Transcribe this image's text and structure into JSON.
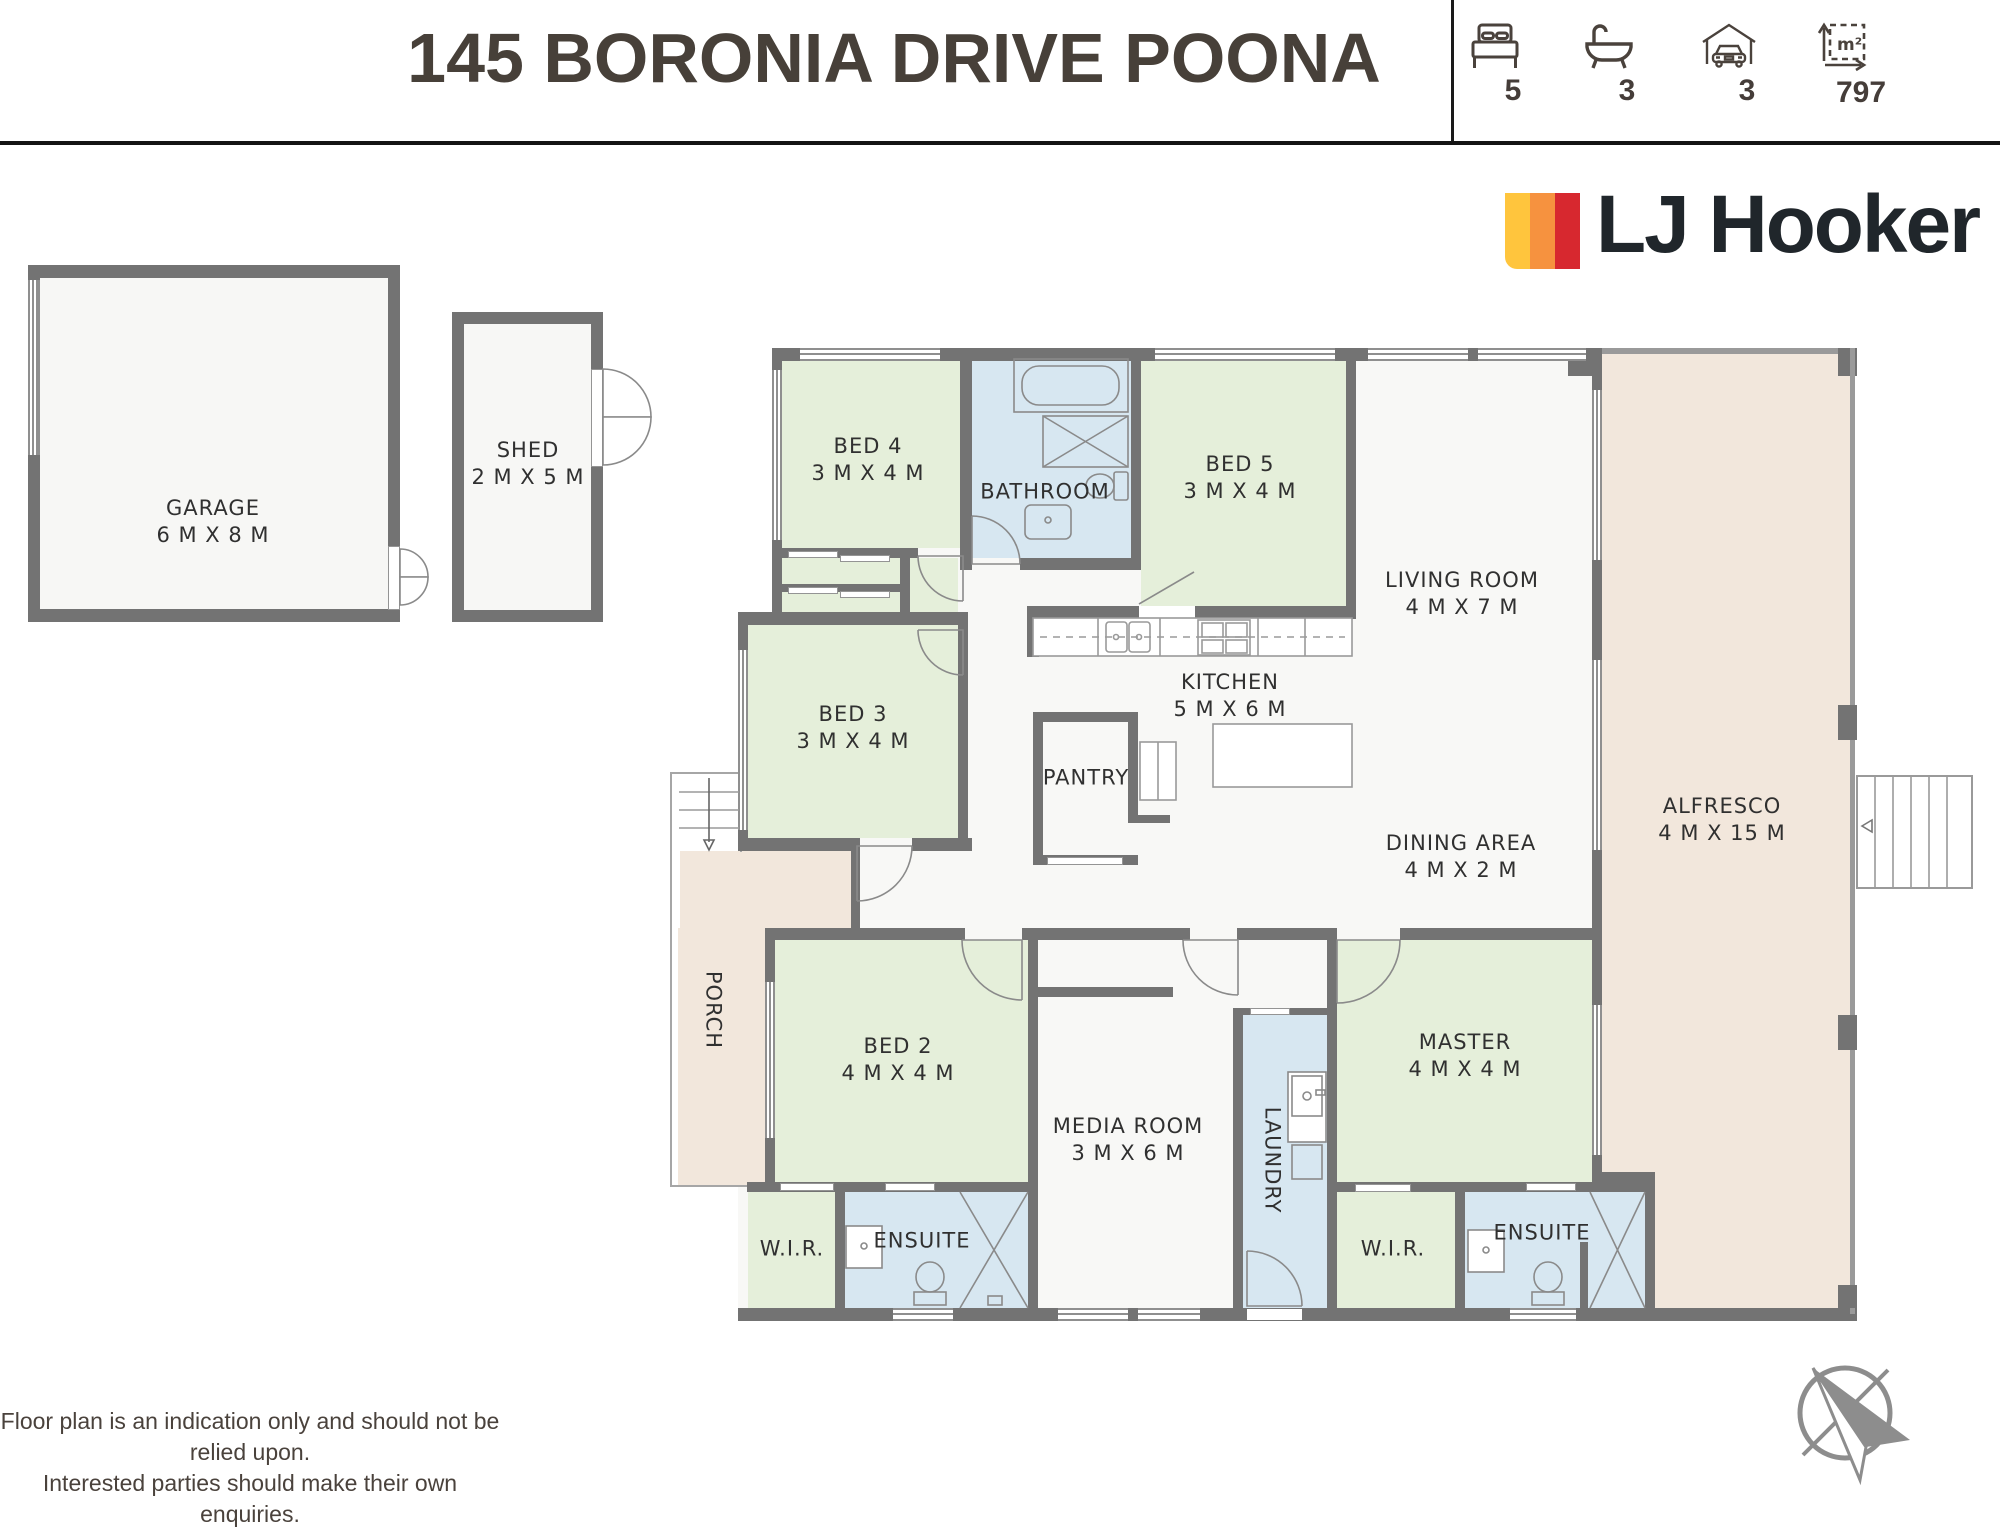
{
  "header": {
    "title": "145 BORONIA DRIVE POONA",
    "stats": [
      {
        "icon": "bed-icon",
        "value": "5"
      },
      {
        "icon": "bath-icon",
        "value": "3"
      },
      {
        "icon": "garage-icon",
        "value": "3"
      },
      {
        "icon": "area-icon",
        "value": "797",
        "unit": "m²"
      }
    ]
  },
  "brand": {
    "name": "LJ Hooker"
  },
  "colors": {
    "brand_yellow": "#FFC53D",
    "brand_orange": "#F6923F",
    "brand_red": "#D7282F",
    "room_green": "#e5efda",
    "room_blue": "#d7e7f1",
    "outdoor_beige": "#f2e7dc",
    "wall_gray": "#737373"
  },
  "plan": {
    "rooms": {
      "garage": {
        "label": "GARAGE",
        "dims": "6 M X 8 M"
      },
      "shed": {
        "label": "SHED",
        "dims": "2 M X 5 M"
      },
      "bed4": {
        "label": "BED 4",
        "dims": "3 M X 4 M"
      },
      "bathroom": {
        "label": "BATHROOM",
        "dims": ""
      },
      "bed5": {
        "label": "BED 5",
        "dims": "3 M X 4 M"
      },
      "living": {
        "label": "LIVING ROOM",
        "dims": "4 M X 7 M"
      },
      "bed3": {
        "label": "BED 3",
        "dims": "3 M X 4 M"
      },
      "kitchen": {
        "label": "KITCHEN",
        "dims": "5 M X 6 M"
      },
      "pantry": {
        "label": "PANTRY",
        "dims": ""
      },
      "dining": {
        "label": "DINING AREA",
        "dims": "4 M X 2 M"
      },
      "alfresco": {
        "label": "ALFRESCO",
        "dims": "4 M X 15 M"
      },
      "porch": {
        "label": "PORCH",
        "dims": ""
      },
      "bed2": {
        "label": "BED 2",
        "dims": "4 M X 4 M"
      },
      "media": {
        "label": "MEDIA ROOM",
        "dims": "3 M X 6 M"
      },
      "laundry": {
        "label": "LAUNDRY",
        "dims": ""
      },
      "master": {
        "label": "MASTER",
        "dims": "4 M X 4 M"
      },
      "wir_left": {
        "label": "W.I.R.",
        "dims": ""
      },
      "ensuite_left": {
        "label": "ENSUITE",
        "dims": ""
      },
      "wir_right": {
        "label": "W.I.R.",
        "dims": ""
      },
      "ensuite_right": {
        "label": "ENSUITE",
        "dims": ""
      }
    }
  },
  "footer": {
    "line1": "Floor plan is an indication only and should not be relied upon.",
    "line2": "Interested parties should make their own enquiries."
  }
}
